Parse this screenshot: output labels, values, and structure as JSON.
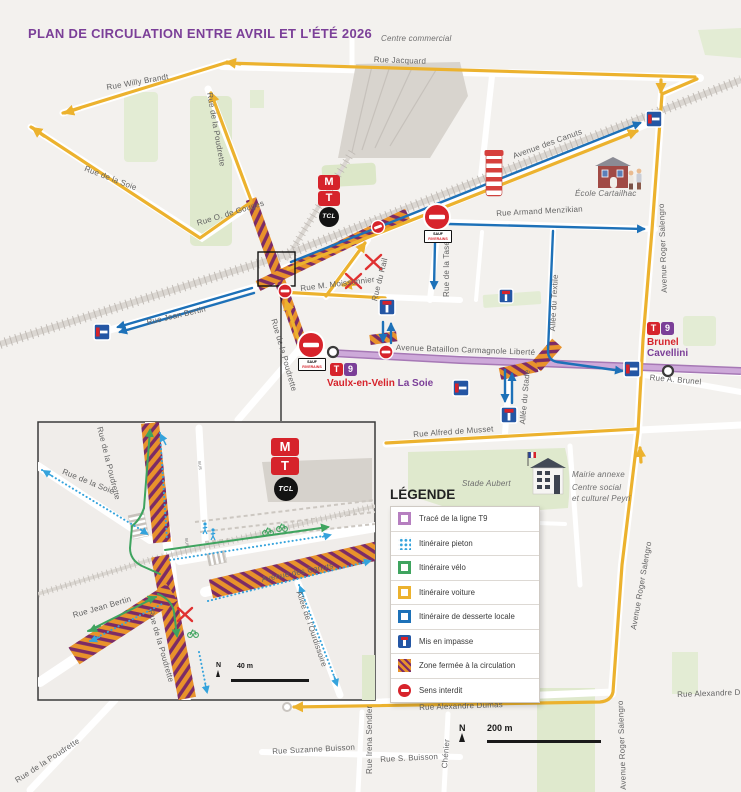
{
  "title": "PLAN DE CIRCULATION  ENTRE AVRIL ET L'ÉTÉ 2026",
  "colors": {
    "title": "#7B3F98",
    "voiture": "#ECB22E",
    "desserte": "#1D71B8",
    "pieton": "#35A3DC",
    "velo": "#3FA45F",
    "t9_fill": "#CDA9D9",
    "t9_edge": "#A678B5",
    "zone_orange": "#E8922B",
    "zone_purple": "#7C2B66",
    "sens_interdit": "#D7232B",
    "impasse": "#2456A4",
    "background": "#F3F1EE"
  },
  "legend": {
    "title": "LÉGENDE",
    "items": [
      {
        "icon": "t9",
        "label": "Tracé de la ligne T9"
      },
      {
        "icon": "pieton",
        "label": "Itinéraire pieton"
      },
      {
        "icon": "velo",
        "label": "Itinéraire vélo"
      },
      {
        "icon": "voiture",
        "label": "Itinéraire voiture"
      },
      {
        "icon": "desserte",
        "label": "Itinéraire de desserte locale"
      },
      {
        "icon": "impasse",
        "label": "Mis en impasse"
      },
      {
        "icon": "zone",
        "label": "Zone fermée à la circulation"
      },
      {
        "icon": "sens",
        "label": "Sens interdit"
      }
    ]
  },
  "transit": {
    "metro": "M",
    "tram": "T",
    "tcl": "TCL"
  },
  "stations": {
    "la_soie": {
      "badge_t": "T",
      "badge_9": "9",
      "name1": "Vaulx-en-Velin",
      "name2": "La Soie"
    },
    "brunel": {
      "badge_t": "T",
      "badge_9": "9",
      "line1": "Brunel",
      "line2": "Cavellini"
    }
  },
  "signs": {
    "sauf": "SAUF",
    "riverains": "RIVERAINS"
  },
  "plaques": [
    {
      "x": 424,
      "y": 230
    },
    {
      "x": 298,
      "y": 358
    }
  ],
  "scale_main": {
    "n": "N",
    "label": "200 m"
  },
  "scale_inset": {
    "n": "N",
    "label": "40 m"
  },
  "labels": [
    {
      "t": "Rue Willy Brandt",
      "x": 106,
      "y": 84,
      "r": -10
    },
    {
      "t": "Rue de la Soie",
      "x": 86,
      "y": 165,
      "r": 21
    },
    {
      "t": "Rue O. de Gouges",
      "x": 196,
      "y": 220,
      "r": -17
    },
    {
      "t": "Rue de la Poudrette",
      "x": 213,
      "y": 92,
      "r": 80
    },
    {
      "t": "Rue Jacquard",
      "x": 374,
      "y": 56,
      "r": 2
    },
    {
      "t": "Centre commercial",
      "x": 381,
      "y": 35,
      "r": 0,
      "i": 1
    },
    {
      "t": "Avenue des Canuts",
      "x": 512,
      "y": 153,
      "r": -20
    },
    {
      "t": "École Cartailhac",
      "x": 575,
      "y": 190,
      "r": 0,
      "i": 1
    },
    {
      "t": "Avenue Roger Salengro",
      "x": 661,
      "y": 293,
      "r": -92
    },
    {
      "t": "Rue Armand Menzikian",
      "x": 496,
      "y": 210,
      "r": -3
    },
    {
      "t": "Rue de la Tase",
      "x": 443,
      "y": 297,
      "r": -90
    },
    {
      "t": "Rue du Rail",
      "x": 371,
      "y": 300,
      "r": -76
    },
    {
      "t": "Rue M. Moissonnier",
      "x": 300,
      "y": 285,
      "r": -7
    },
    {
      "t": "Rue Jean Bertin",
      "x": 146,
      "y": 319,
      "r": -13
    },
    {
      "t": "Rue de la Poudrette",
      "x": 277,
      "y": 318,
      "r": 74
    },
    {
      "t": "Avenue Bataillon Carmagnole Liberté",
      "x": 396,
      "y": 344,
      "r": 2
    },
    {
      "t": "Allée du Textile",
      "x": 549,
      "y": 331,
      "r": -87
    },
    {
      "t": "Allée du Stade",
      "x": 519,
      "y": 424,
      "r": -85
    },
    {
      "t": "Rue Alfred de Musset",
      "x": 413,
      "y": 431,
      "r": -4
    },
    {
      "t": "Stade Aubert",
      "x": 462,
      "y": 480,
      "r": 0,
      "i": 1
    },
    {
      "t": "Mairie annexe",
      "x": 572,
      "y": 471,
      "i": 1
    },
    {
      "t": "Centre social",
      "x": 572,
      "y": 484,
      "i": 1
    },
    {
      "t": "et culturel Peyri",
      "x": 572,
      "y": 495,
      "i": 1
    },
    {
      "t": "Rue A. Brunel",
      "x": 650,
      "y": 374,
      "r": 5
    },
    {
      "t": "Avenue Roger Salengro",
      "x": 630,
      "y": 629,
      "r": -80
    },
    {
      "t": "Rue Alexandre Dumas",
      "x": 419,
      "y": 704,
      "r": -2
    },
    {
      "t": "Rue Suzanne Buisson",
      "x": 272,
      "y": 748,
      "r": -3
    },
    {
      "t": "Rue Irena Sendler",
      "x": 366,
      "y": 774,
      "r": -90
    },
    {
      "t": "Rue S. Buisson",
      "x": 380,
      "y": 756,
      "r": -3
    },
    {
      "t": "Chénier",
      "x": 441,
      "y": 768,
      "r": -85
    },
    {
      "t": "Rue de la Poudrette",
      "x": 14,
      "y": 778,
      "r": -33
    },
    {
      "t": "Rue Alexandre Dumas",
      "x": 677,
      "y": 691,
      "r": -2
    },
    {
      "t": "Avenue Roger Salengro",
      "x": 620,
      "y": 790,
      "r": -92
    }
  ],
  "inset_labels": [
    {
      "t": "Rue de la Poudrette",
      "x": 103,
      "y": 426,
      "r": 76
    },
    {
      "t": "Rue de la Soie",
      "x": 64,
      "y": 468,
      "r": 22
    },
    {
      "t": "Rue Jean Bertin",
      "x": 72,
      "y": 612,
      "r": -16
    },
    {
      "t": "Rue de la Poudrette",
      "x": 154,
      "y": 609,
      "r": 74
    },
    {
      "t": "Avenue des Canuts",
      "x": 261,
      "y": 576,
      "r": -11
    },
    {
      "t": "Allée de l'Ourdissoire",
      "x": 302,
      "y": 590,
      "r": 71
    },
    {
      "t": "BUS",
      "x": 201,
      "y": 461,
      "r": 83,
      "s": 4
    },
    {
      "t": "BUS",
      "x": 188,
      "y": 538,
      "r": 83,
      "s": 4
    }
  ]
}
